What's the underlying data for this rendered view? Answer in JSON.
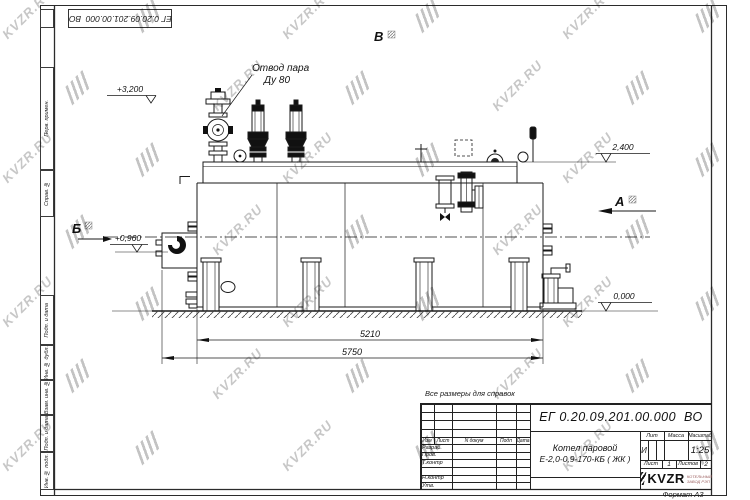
{
  "watermark": {
    "text": "KVZR.RU"
  },
  "corner_stamp": {
    "doc_number": "ЕГ 0.20.09.201.00.000  ВО"
  },
  "margin": {
    "labels": [
      "Перв. примен.",
      "Справ. №",
      "Подп. и дата",
      "Инв. № дубл.",
      "Взам. инв. №",
      "Подп. и дата",
      "Инв. № подл."
    ]
  },
  "drawing": {
    "callout": {
      "line1": "Отвод пара",
      "line2": "Ду 80"
    },
    "elevations": {
      "e1": "+3,200",
      "e2": "2,400",
      "e3": "+0,960",
      "e4": "0,000"
    },
    "views": {
      "top": "В",
      "left": "Б",
      "right": "А"
    },
    "dims": {
      "d1": "5210",
      "d2": "5750"
    }
  },
  "note": {
    "text": "Все размеры для справок"
  },
  "title_block": {
    "doc_number": "ЕГ 0.20.09.201.00.000  ВО",
    "product": {
      "line1": "Котел паровой",
      "line2": "Е-2,0-0,9-170-КБ ( ЖК )"
    },
    "cols": {
      "izm": "Изм",
      "list": "Лист",
      "ndokum": "N докум",
      "podp": "Подп",
      "data": "Дата"
    },
    "roles": {
      "r1": "Разраб.",
      "r2": "Пров.",
      "r3": "Т.контр",
      "r4": "Н.контр",
      "r5": "Утв."
    },
    "lit": {
      "label": "Лит",
      "value": "И"
    },
    "massa": {
      "label": "Масса",
      "value": ""
    },
    "scale": {
      "label": "Масштаб",
      "value": "1:25"
    },
    "sheet": {
      "label": "Лист",
      "value": "1"
    },
    "sheets": {
      "label": "Листов",
      "value": "2"
    },
    "logo": {
      "text": "KVZR",
      "sub1": "КОТЕЛЬНЫЙ",
      "sub2": "ЗАВОД РЭП"
    },
    "format": "Формат А3"
  }
}
